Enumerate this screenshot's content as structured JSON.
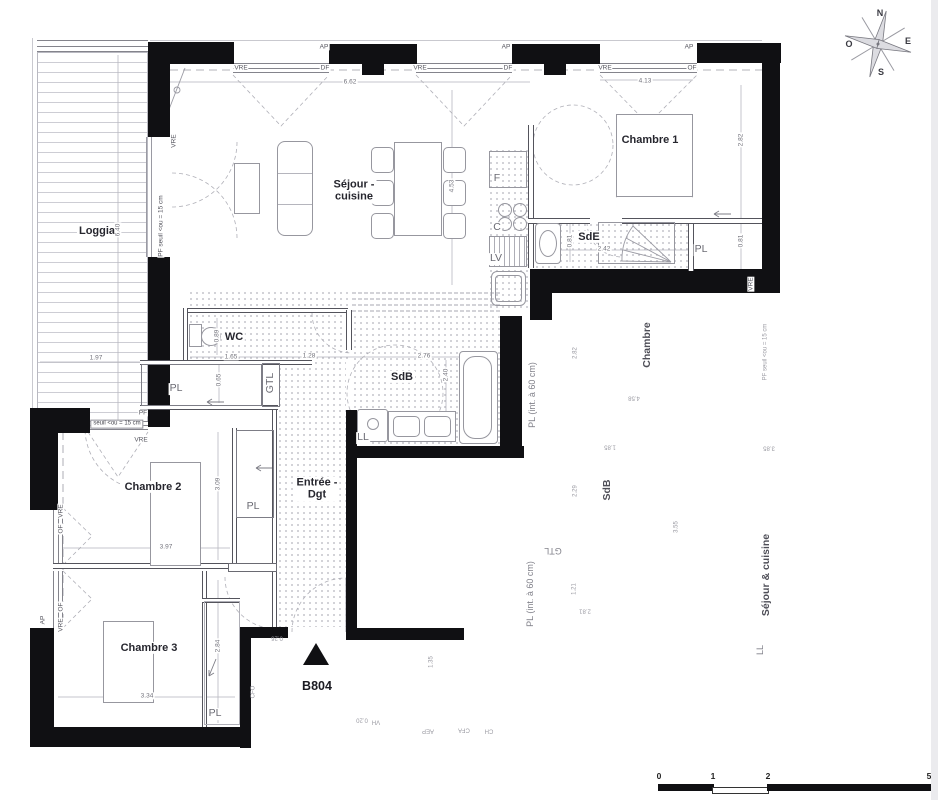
{
  "floorplan": {
    "unit": "B804",
    "type": "apartment-floor-plan"
  },
  "colors": {
    "wall": "#101013",
    "dots": "#b2b2bb",
    "dim_text": "#73737c",
    "room_text": "#26262e"
  },
  "labels": [
    {
      "t": "Loggia",
      "x": 97,
      "y": 231,
      "c": "room",
      "n": "room-label-loggia"
    },
    {
      "t": "Séjour -\ncuisine",
      "x": 354,
      "y": 191,
      "c": "room",
      "n": "room-label-sejour-cuisine"
    },
    {
      "t": "Chambre 1",
      "x": 650,
      "y": 140,
      "c": "room",
      "n": "room-label-chambre-1"
    },
    {
      "t": "SdE",
      "x": 589,
      "y": 237,
      "c": "room",
      "n": "room-label-sde"
    },
    {
      "t": "WC",
      "x": 234,
      "y": 337,
      "c": "room",
      "n": "room-label-wc"
    },
    {
      "t": "SdB",
      "x": 402,
      "y": 377,
      "c": "room",
      "n": "room-label-sdb"
    },
    {
      "t": "Entrée -\nDgt",
      "x": 317,
      "y": 489,
      "c": "room",
      "n": "room-label-entree-dgt"
    },
    {
      "t": "Chambre 2",
      "x": 153,
      "y": 487,
      "c": "room",
      "n": "room-label-chambre-2"
    },
    {
      "t": "Chambre 3",
      "x": 149,
      "y": 648,
      "c": "room",
      "n": "room-label-chambre-3"
    },
    {
      "t": "B804",
      "x": 317,
      "y": 686,
      "c": "unit",
      "n": "unit-number"
    },
    {
      "t": "PL",
      "x": 701,
      "y": 250,
      "c": "sub",
      "n": "closet-label"
    },
    {
      "t": "PL",
      "x": 176,
      "y": 389,
      "c": "sub",
      "n": "closet-label"
    },
    {
      "t": "PL",
      "x": 253,
      "y": 507,
      "c": "sub",
      "n": "closet-label"
    },
    {
      "t": "PL",
      "x": 215,
      "y": 714,
      "c": "sub",
      "n": "closet-label"
    },
    {
      "t": "LL",
      "x": 363,
      "y": 438,
      "c": "sub",
      "n": "washer-label"
    },
    {
      "t": "GTL",
      "x": 271,
      "y": 383,
      "c": "sub",
      "r": -90,
      "n": "gtl-label"
    },
    {
      "t": "F",
      "x": 497,
      "y": 179,
      "c": "sub",
      "n": "fridge-label"
    },
    {
      "t": "C",
      "x": 497,
      "y": 228,
      "c": "sub",
      "n": "cooktop-label"
    },
    {
      "t": "LV",
      "x": 496,
      "y": 259,
      "c": "sub",
      "n": "dishwasher-label"
    },
    {
      "t": "AP",
      "x": 324,
      "y": 47,
      "c": "tag",
      "n": "opening-tag"
    },
    {
      "t": "AP",
      "x": 506,
      "y": 47,
      "c": "tag",
      "n": "opening-tag"
    },
    {
      "t": "AP",
      "x": 689,
      "y": 47,
      "c": "tag",
      "n": "opening-tag"
    },
    {
      "t": "VRE",
      "x": 241,
      "y": 68,
      "c": "tag",
      "n": "opening-tag"
    },
    {
      "t": "DF",
      "x": 325,
      "y": 68,
      "c": "tag",
      "n": "opening-tag"
    },
    {
      "t": "VRE",
      "x": 420,
      "y": 68,
      "c": "tag",
      "n": "opening-tag"
    },
    {
      "t": "DF",
      "x": 508,
      "y": 68,
      "c": "tag",
      "n": "opening-tag"
    },
    {
      "t": "VRE",
      "x": 605,
      "y": 68,
      "c": "tag",
      "n": "opening-tag"
    },
    {
      "t": "OF",
      "x": 692,
      "y": 68,
      "c": "tag",
      "n": "opening-tag"
    },
    {
      "t": "VRE",
      "x": 174,
      "y": 141,
      "c": "tag",
      "r": -90,
      "n": "opening-tag"
    },
    {
      "t": "VRE",
      "x": 141,
      "y": 440,
      "c": "tag",
      "n": "opening-tag"
    },
    {
      "t": "PF",
      "x": 143,
      "y": 413,
      "c": "tag",
      "n": "opening-tag"
    },
    {
      "t": "seuil <ou = 15 cm",
      "x": 117,
      "y": 424,
      "c": "tagboxed",
      "n": "threshold-tag"
    },
    {
      "t": "PF seuil <ou = 15 cm",
      "x": 161,
      "y": 226,
      "c": "tag",
      "r": -90,
      "n": "threshold-tag"
    },
    {
      "t": "VRE",
      "x": 61,
      "y": 511,
      "c": "tag",
      "r": -90,
      "n": "opening-tag"
    },
    {
      "t": "OF",
      "x": 61,
      "y": 529,
      "c": "tag",
      "r": -90,
      "n": "opening-tag"
    },
    {
      "t": "OF",
      "x": 61,
      "y": 607,
      "c": "tag",
      "r": -90,
      "n": "opening-tag"
    },
    {
      "t": "VRE",
      "x": 61,
      "y": 625,
      "c": "tag",
      "r": -90,
      "n": "opening-tag"
    },
    {
      "t": "AP",
      "x": 43,
      "y": 620,
      "c": "tag",
      "r": -90,
      "n": "opening-tag"
    },
    {
      "t": "VRE",
      "x": 751,
      "y": 284,
      "c": "tag",
      "r": -90,
      "n": "opening-tag"
    },
    {
      "t": "6.62",
      "x": 350,
      "y": 82,
      "c": "dim",
      "n": "dimension-label"
    },
    {
      "t": "4.13",
      "x": 645,
      "y": 81,
      "c": "dim",
      "n": "dimension-label"
    },
    {
      "t": "4.53",
      "x": 452,
      "y": 186,
      "c": "dim",
      "r": -90,
      "n": "dimension-label"
    },
    {
      "t": "2.82",
      "x": 741,
      "y": 140,
      "c": "dim",
      "r": -90,
      "n": "dimension-label"
    },
    {
      "t": "0.81",
      "x": 741,
      "y": 241,
      "c": "dim",
      "r": -90,
      "n": "dimension-label"
    },
    {
      "t": "2.42",
      "x": 604,
      "y": 249,
      "c": "dim",
      "n": "dimension-label"
    },
    {
      "t": "0.81",
      "x": 570,
      "y": 241,
      "c": "dim",
      "r": -90,
      "n": "dimension-label"
    },
    {
      "t": "6.40",
      "x": 118,
      "y": 230,
      "c": "dim",
      "r": -90,
      "n": "dimension-label"
    },
    {
      "t": "1.97",
      "x": 96,
      "y": 358,
      "c": "dim",
      "n": "dimension-label"
    },
    {
      "t": "0.89",
      "x": 217,
      "y": 336,
      "c": "dim",
      "r": -90,
      "n": "dimension-label"
    },
    {
      "t": "1.65",
      "x": 231,
      "y": 357,
      "c": "dim",
      "n": "dimension-label"
    },
    {
      "t": "1.28",
      "x": 309,
      "y": 356,
      "c": "dim",
      "n": "dimension-label"
    },
    {
      "t": "2.76",
      "x": 424,
      "y": 356,
      "c": "dim",
      "n": "dimension-label"
    },
    {
      "t": "2.40",
      "x": 446,
      "y": 375,
      "c": "dim",
      "r": -90,
      "n": "dimension-label"
    },
    {
      "t": "0.65",
      "x": 219,
      "y": 380,
      "c": "dim",
      "r": -90,
      "n": "dimension-label"
    },
    {
      "t": "3.97",
      "x": 166,
      "y": 547,
      "c": "dim",
      "n": "dimension-label"
    },
    {
      "t": "3.09",
      "x": 218,
      "y": 484,
      "c": "dim",
      "r": -90,
      "n": "dimension-label"
    },
    {
      "t": "3.34",
      "x": 147,
      "y": 696,
      "c": "dim",
      "n": "dimension-label"
    },
    {
      "t": "2.84",
      "x": 218,
      "y": 646,
      "c": "dim",
      "r": -90,
      "n": "dimension-label"
    },
    {
      "t": "Chambre",
      "x": 648,
      "y": 345,
      "c": "nroom",
      "r": -90,
      "n": "neighbor-room-label"
    },
    {
      "t": "PF seuil <ou = 15 cm",
      "x": 766,
      "y": 352,
      "c": "ntag",
      "r": -90,
      "n": "neighbor-label"
    },
    {
      "t": "PL (int. à 60 cm)",
      "x": 532,
      "y": 395,
      "c": "nsub",
      "r": -90,
      "n": "neighbor-label"
    },
    {
      "t": "PL (int. à 60 cm)",
      "x": 530,
      "y": 594,
      "c": "nsub",
      "r": -90,
      "n": "neighbor-label"
    },
    {
      "t": "SdB",
      "x": 608,
      "y": 490,
      "c": "nroom",
      "r": -90,
      "n": "neighbor-room-label"
    },
    {
      "t": "GTL",
      "x": 553,
      "y": 551,
      "c": "nsub",
      "r": 180,
      "n": "neighbor-label"
    },
    {
      "t": "Séjour & cuisine",
      "x": 767,
      "y": 575,
      "c": "nroom",
      "r": -90,
      "n": "neighbor-room-label"
    },
    {
      "t": "LL",
      "x": 760,
      "y": 650,
      "c": "nsub",
      "r": -90,
      "n": "neighbor-label"
    },
    {
      "t": "2.82",
      "x": 576,
      "y": 353,
      "c": "ndim",
      "r": -90,
      "n": "neighbor-dimension"
    },
    {
      "t": "4.58",
      "x": 634,
      "y": 397,
      "c": "ndim",
      "r": 180,
      "n": "neighbor-dimension"
    },
    {
      "t": "1.85",
      "x": 610,
      "y": 446,
      "c": "ndim",
      "r": 180,
      "n": "neighbor-dimension"
    },
    {
      "t": "3.85",
      "x": 769,
      "y": 447,
      "c": "ndim",
      "r": 180,
      "n": "neighbor-dimension"
    },
    {
      "t": "2.29",
      "x": 576,
      "y": 491,
      "c": "ndim",
      "r": -90,
      "n": "neighbor-dimension"
    },
    {
      "t": "3.55",
      "x": 677,
      "y": 527,
      "c": "ndim",
      "r": -90,
      "n": "neighbor-dimension"
    },
    {
      "t": "1.21",
      "x": 575,
      "y": 589,
      "c": "ndim",
      "r": -90,
      "n": "neighbor-dimension"
    },
    {
      "t": "2.81",
      "x": 585,
      "y": 610,
      "c": "ndim",
      "r": 180,
      "n": "neighbor-dimension"
    },
    {
      "t": "1.35",
      "x": 432,
      "y": 662,
      "c": "ndim",
      "r": -90,
      "n": "neighbor-dimension"
    },
    {
      "t": "0.26",
      "x": 277,
      "y": 637,
      "c": "ndim",
      "r": 180,
      "n": "neighbor-dimension"
    },
    {
      "t": "CFO",
      "x": 254,
      "y": 692,
      "c": "ntag",
      "r": -90,
      "n": "utility-tag"
    },
    {
      "t": "0.20",
      "x": 362,
      "y": 719,
      "c": "ndim",
      "r": 180,
      "n": "neighbor-dimension"
    },
    {
      "t": "VH",
      "x": 376,
      "y": 721,
      "c": "ntag",
      "r": 180,
      "n": "utility-tag"
    },
    {
      "t": "AEP",
      "x": 428,
      "y": 730,
      "c": "ntag",
      "r": 180,
      "n": "utility-tag"
    },
    {
      "t": "CFA",
      "x": 464,
      "y": 729,
      "c": "ntag",
      "r": 180,
      "n": "utility-tag"
    },
    {
      "t": "CH",
      "x": 489,
      "y": 730,
      "c": "ntag",
      "r": 180,
      "n": "utility-tag"
    },
    {
      "t": "N",
      "x": 880,
      "y": 13,
      "c": "comp",
      "n": "compass-letter-n"
    },
    {
      "t": "E",
      "x": 908,
      "y": 41,
      "c": "comp",
      "n": "compass-letter-e"
    },
    {
      "t": "S",
      "x": 881,
      "y": 72,
      "c": "comp",
      "n": "compass-letter-s"
    },
    {
      "t": "O",
      "x": 849,
      "y": 44,
      "c": "comp",
      "n": "compass-letter-o"
    },
    {
      "t": "0",
      "x": 659,
      "y": 777,
      "c": "scalenum",
      "n": "scale-tick-label"
    },
    {
      "t": "1",
      "x": 713,
      "y": 777,
      "c": "scalenum",
      "n": "scale-tick-label"
    },
    {
      "t": "2",
      "x": 768,
      "y": 777,
      "c": "scalenum",
      "n": "scale-tick-label"
    },
    {
      "t": "5",
      "x": 929,
      "y": 777,
      "c": "scalenum",
      "n": "scale-tick-label"
    }
  ]
}
